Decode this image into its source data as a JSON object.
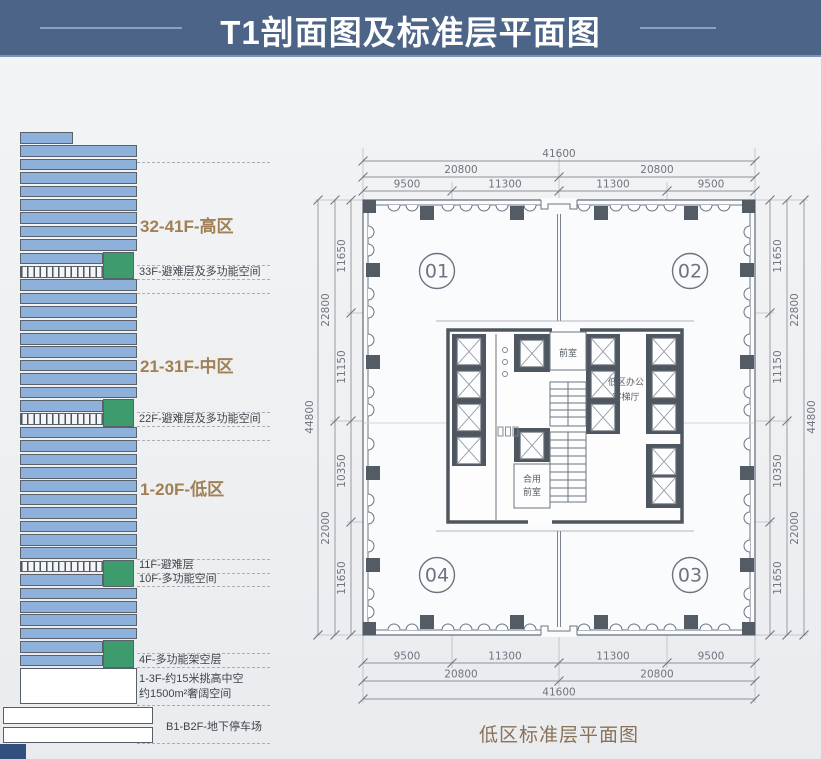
{
  "header": {
    "title": "T1剖面图及标准层平面图"
  },
  "section": {
    "structure": {
      "rows": [
        "short",
        "full",
        "full",
        "full",
        "full",
        "full",
        "full",
        "full",
        "full",
        "half",
        "hatch",
        "full",
        "full",
        "full",
        "full",
        "full",
        "full",
        "full",
        "full",
        "full",
        "half",
        "hatch",
        "full",
        "full",
        "full",
        "full",
        "full",
        "full",
        "full",
        "full",
        "full",
        "full",
        "hatch",
        "half",
        "full",
        "full",
        "full",
        "full",
        "half",
        "half"
      ],
      "green_spans": [
        9,
        20,
        32,
        38
      ]
    },
    "labels": {
      "zone_high": "32-41F-高区",
      "refuge_33f": "33F-避难层及多功能空间",
      "zone_mid": "21-31F-中区",
      "refuge_22f": "22F-避难层及多功能空间",
      "zone_low": "1-20F-低区",
      "refuge_11f": "11F-避难层",
      "multi_10f": "10F-多功能空间",
      "multi_4f": "4F-多功能架空层",
      "lobby_1": "1-3F-约15米挑高中空",
      "lobby_2": "约1500m²奢阔空间",
      "basement": "B1-B2F-地下停车场"
    },
    "colors": {
      "floor_blue": "#8db1da",
      "refuge_green": "#3d9b6d",
      "zone_label_gold": "#a08054"
    }
  },
  "plan": {
    "caption": "低区标准层平面图",
    "units": [
      "01",
      "02",
      "03",
      "04"
    ],
    "rooms": {
      "front": "前室",
      "hall1": "低区办公",
      "hall2": "客梯厅",
      "shared1": "合用",
      "shared2": "前室"
    },
    "dims": {
      "h": {
        "total": "41600",
        "halves": [
          "20800",
          "20800"
        ],
        "bays": [
          "9500",
          "11300",
          "11300",
          "9500"
        ]
      },
      "v": {
        "total": "44800",
        "halves": [
          "22800",
          "22000"
        ],
        "bays": [
          "11650",
          "11150",
          "10350",
          "11650"
        ]
      }
    }
  },
  "theme": {
    "header_blue": "#4b6487",
    "line_gray": "#6b7480",
    "caption_brown": "#8a7258"
  }
}
